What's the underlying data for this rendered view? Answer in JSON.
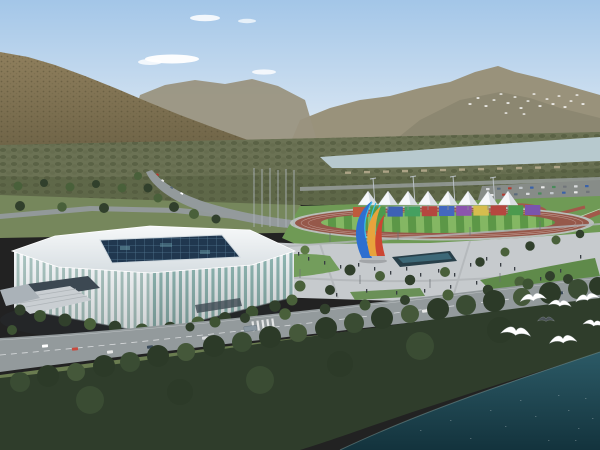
{
  "scene": {
    "type": "aerial architectural rendering",
    "description": "Daytime aerial rendering of a white lattice-facade stadium beside an outdoor athletics track with a row of white canopy tents and a rainbow banner wall, a colorful flame sculpture on a plaza, tree-lined boulevards with traffic, a pale river and wooded mountains behind, dark forest and teal water in the foreground with white gulls flying",
    "landmarks": [
      "stadium",
      "athletics-track",
      "canopy-tents",
      "banner-wall",
      "flame-sculpture",
      "plaza",
      "reflecting-pool",
      "parking-lot",
      "boulevard",
      "river",
      "mountains",
      "forest",
      "water",
      "gulls"
    ],
    "tent_count": 8,
    "banner_panel_count": 11,
    "foreground_gull_count": 7,
    "distant_flock_count": 20
  },
  "colors": {
    "sky_top": "#a3c6e8",
    "sky_horizon": "#e8eff5",
    "cloud": "#ffffff",
    "far_mountain": "#99927b",
    "ridge": "#8b8670",
    "left_ridge": "#9a947f",
    "mountain_light": "#8f7f5d",
    "mountain_dark": "#5e563c",
    "valley_trees": "#6b7254",
    "river": "#b7c9ce",
    "road": "#939a9c",
    "plaza": "#c6cacd",
    "lawn": "#6f9a55",
    "track": "#96584a",
    "field_a": "#5c9747",
    "field_b": "#84b763",
    "tent": "#f6f8fa",
    "stadium_white": "#edf1f3",
    "stadium_glass": "#8fb6b2",
    "roof_light": "#f6f8f9",
    "roof_dark": "#d7dee2",
    "skylight": "#20374f",
    "pool": "#283f49",
    "water_top": "#2c5a66",
    "water_bottom": "#13333d",
    "forest": "#2f3d2b",
    "bird": "#ffffff",
    "sculpture_blue": "#2e6fd0",
    "sculpture_cyan": "#38c2e8",
    "sculpture_yellow": "#e8a33c",
    "sculpture_red": "#cc4633"
  },
  "banner_colors": [
    "#bf5a3c",
    "#4c9a4e",
    "#3e62b5",
    "#45a060",
    "#b5473f",
    "#4468bf",
    "#8b55ad",
    "#d6bd4e",
    "#b5473f",
    "#4c9a4e",
    "#7a55ad"
  ]
}
